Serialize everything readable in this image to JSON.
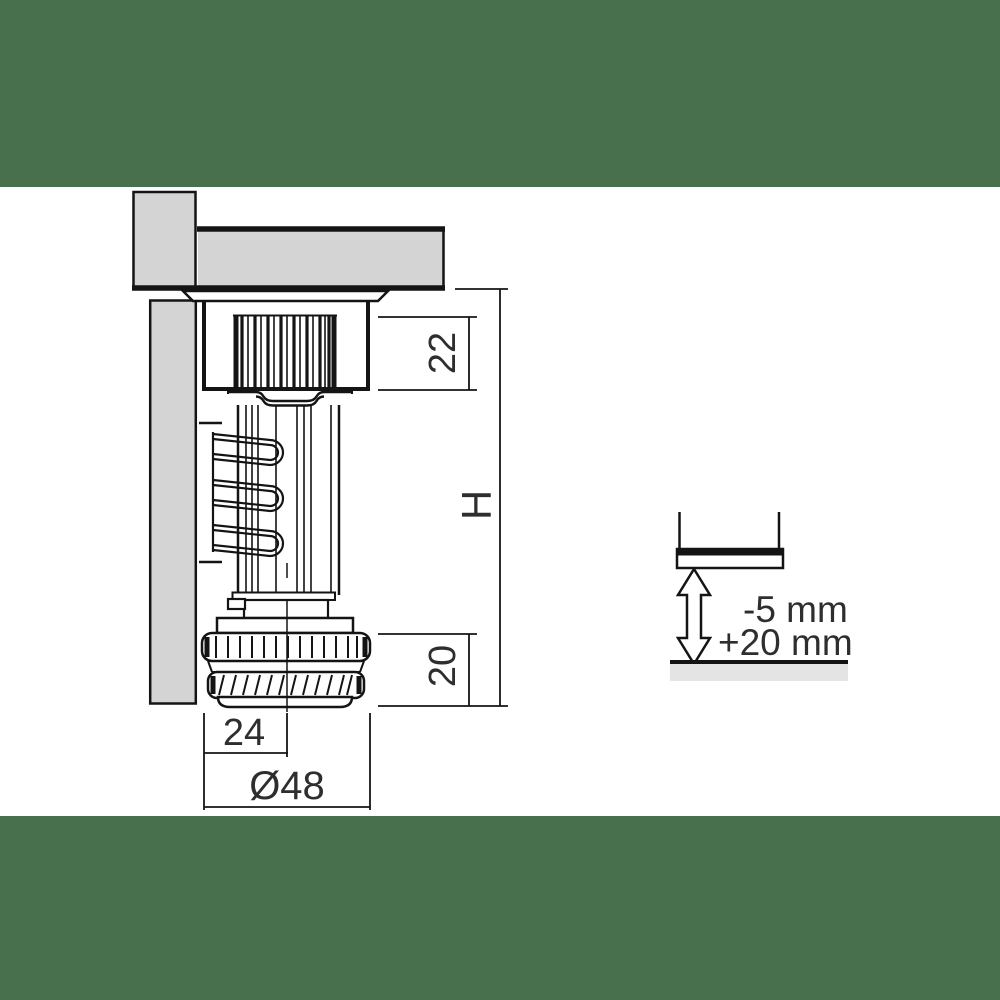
{
  "drawing": {
    "dim_22": "22",
    "dim_H": "H",
    "dim_20": "20",
    "dim_24": "24",
    "dim_diameter": "Ø48",
    "adjust_minus": "-5 mm",
    "adjust_plus": "+20 mm"
  },
  "colors": {
    "band_green": "#49704D",
    "panel_gray": "#D4D4D4",
    "floor_gray": "#E4E4E4",
    "line_black": "#141414",
    "text_dark": "#2E2E2E"
  }
}
